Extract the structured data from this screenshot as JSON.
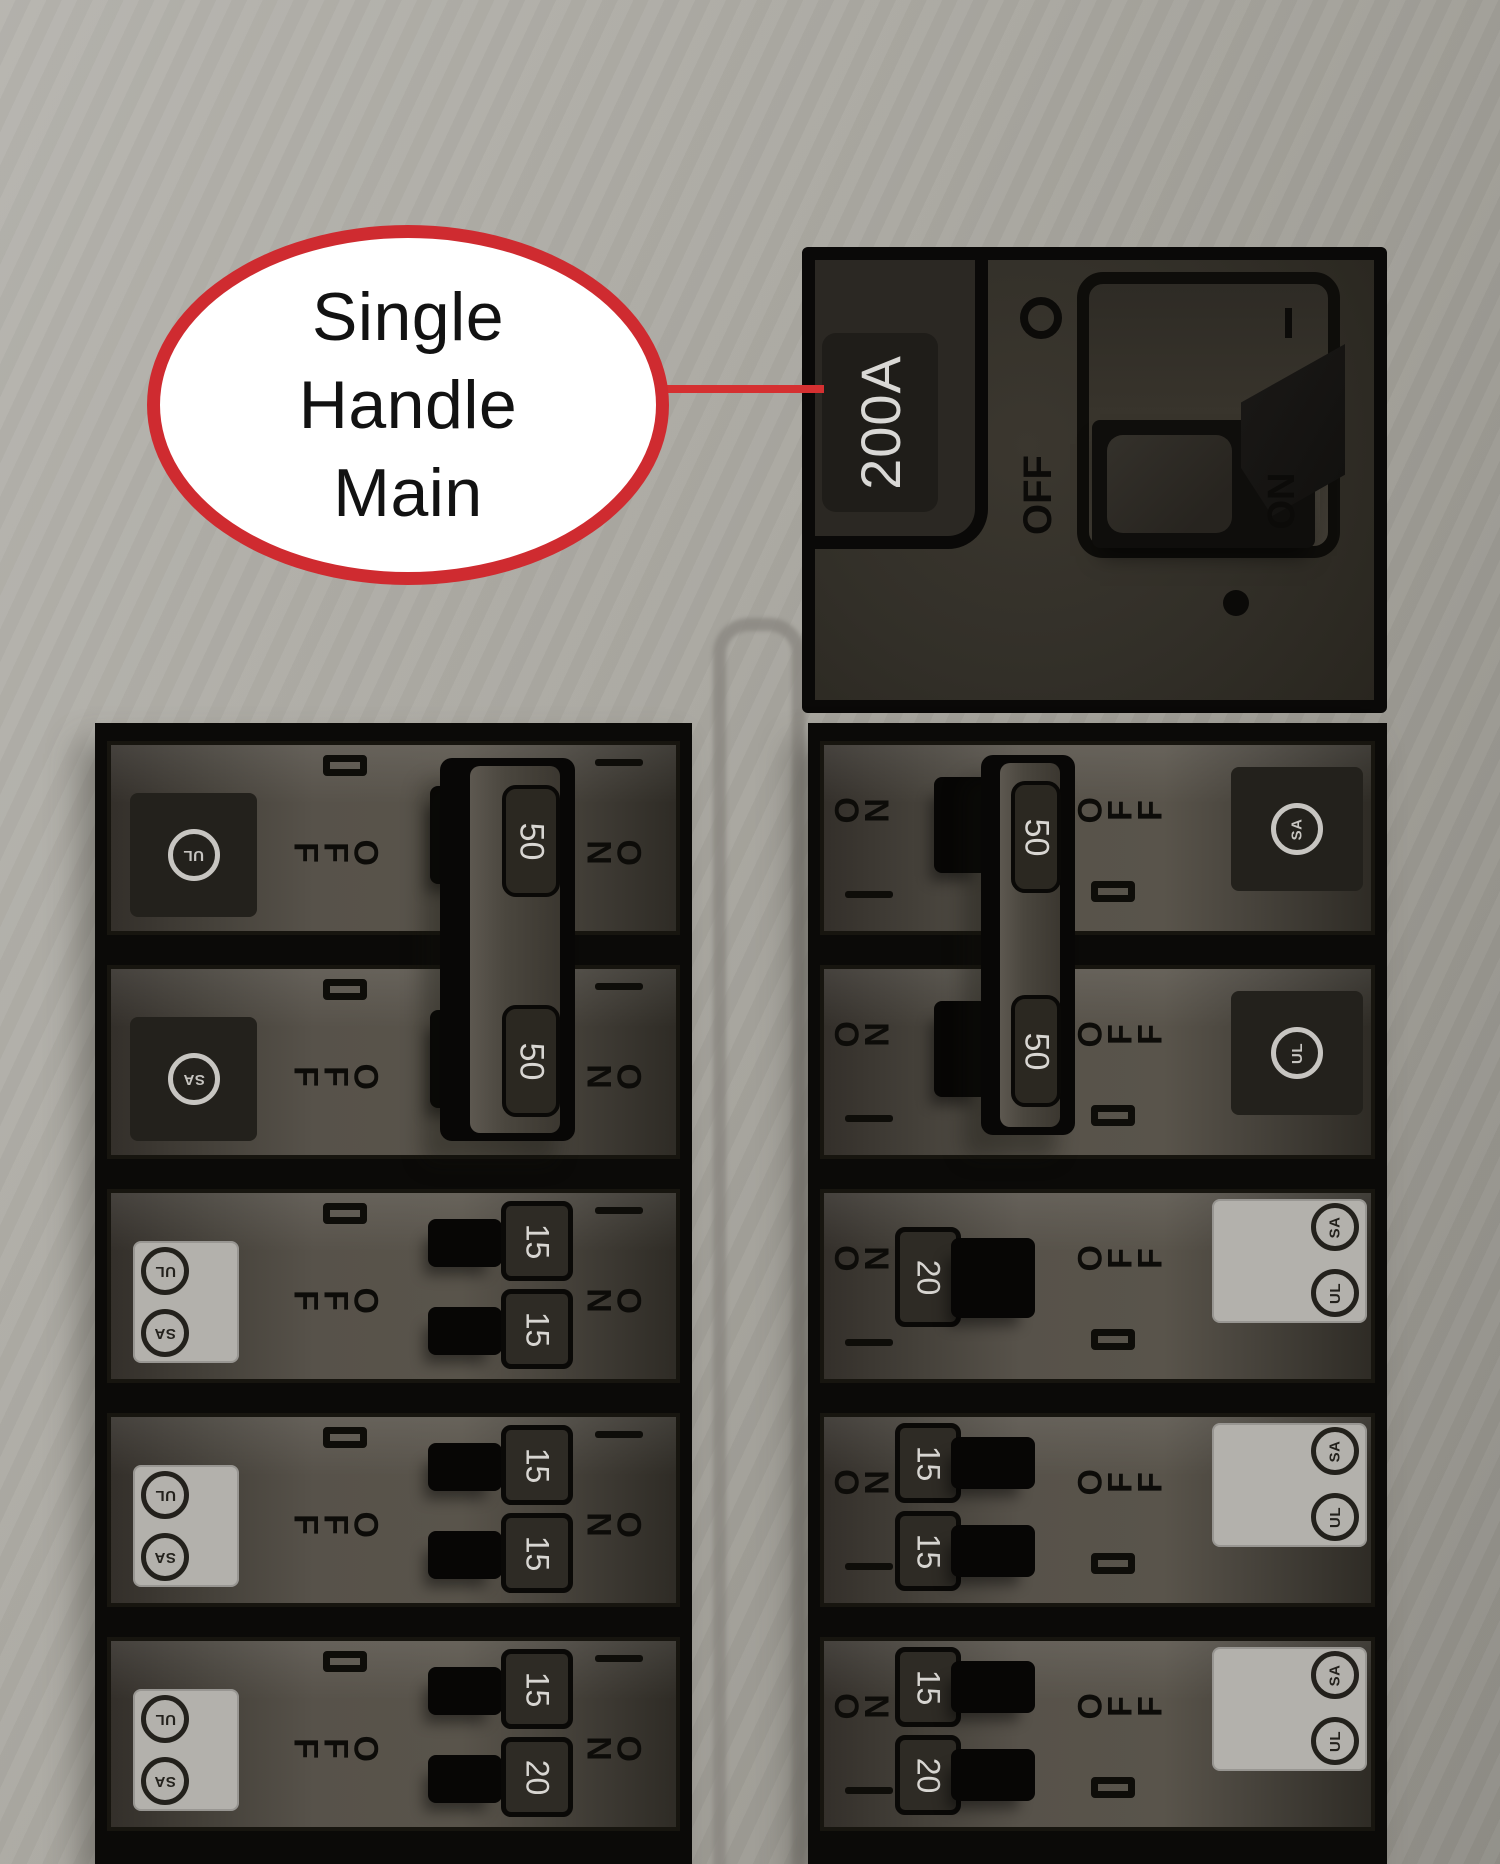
{
  "background": {
    "gradient_top": "#b6b4ae",
    "gradient_bottom": "#908e87"
  },
  "accent_red": "#cf2b30",
  "callout": {
    "lines": [
      "Single",
      "Handle",
      "Main"
    ]
  },
  "main_breaker": {
    "rating_label": "200A",
    "off_label": "OFF",
    "on_label": "ON",
    "on_mark": "I",
    "state": "on"
  },
  "columns": {
    "left": {
      "on_label": "ON",
      "off_label": "OFF",
      "tied_handle_amps": [
        "50",
        "50"
      ],
      "rows": [
        {
          "type": "pair-top",
          "square": "dark",
          "logos": [
            "UL"
          ]
        },
        {
          "type": "pair-bottom",
          "square": "dark",
          "logos": [
            "SA"
          ]
        },
        {
          "type": "tandem",
          "square": "light",
          "logos": [
            "UL",
            "SA"
          ],
          "amps": [
            "15",
            "15"
          ]
        },
        {
          "type": "tandem",
          "square": "light",
          "logos": [
            "UL",
            "SA"
          ],
          "amps": [
            "15",
            "15"
          ]
        },
        {
          "type": "tandem",
          "square": "light",
          "logos": [
            "UL",
            "SA"
          ],
          "amps": [
            "15",
            "20"
          ]
        }
      ]
    },
    "right": {
      "on_label": "ON",
      "off_label": "OFF",
      "tied_handle_amps": [
        "50",
        "50"
      ],
      "rows": [
        {
          "type": "pair-top",
          "square": "dark",
          "logos": [
            "SA"
          ]
        },
        {
          "type": "pair-bottom",
          "square": "dark",
          "logos": [
            "UL"
          ]
        },
        {
          "type": "single",
          "square": "light",
          "logos": [
            "SA",
            "UL"
          ],
          "amps": [
            "20"
          ]
        },
        {
          "type": "tandem",
          "square": "light",
          "logos": [
            "SA",
            "UL"
          ],
          "amps": [
            "15",
            "15"
          ]
        },
        {
          "type": "tandem",
          "square": "light",
          "logos": [
            "SA",
            "UL"
          ],
          "amps": [
            "15",
            "20"
          ]
        }
      ]
    }
  }
}
